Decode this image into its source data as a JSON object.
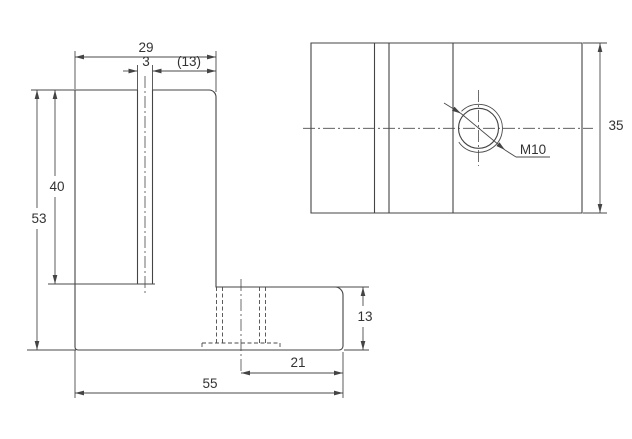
{
  "page": {
    "background": "#ffffff"
  },
  "drawing": {
    "description": "Two-view engineering drawing of an L-shaped bracket with a vertical slot and an M10 tapped hole",
    "line_color": "#444444",
    "text_color": "#333333",
    "front_view": {
      "dims": {
        "upright_width": "29",
        "slot_width": "3",
        "slot_offset_ref": "(13)",
        "slot_depth": "40",
        "total_height": "53",
        "base_thickness": "13",
        "hole_to_edge": "21",
        "total_width": "55"
      }
    },
    "top_view": {
      "dims": {
        "depth": "35"
      },
      "thread_callout": "M10"
    }
  }
}
